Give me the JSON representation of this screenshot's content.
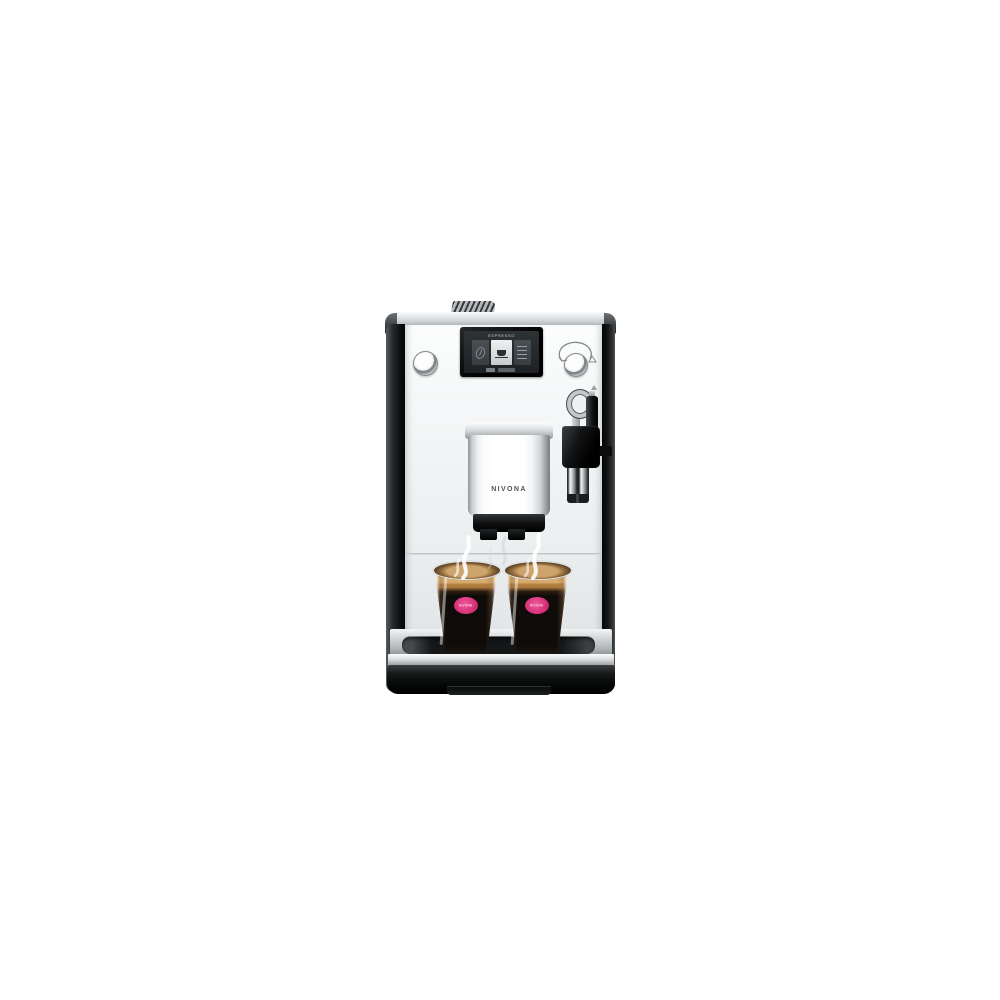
{
  "machine": {
    "brand": "NIVONA",
    "display": {
      "title": "ESPRESSO"
    },
    "spout_label": "NIVONA",
    "glasses": {
      "logo_text": "NIVONA"
    }
  },
  "colors": {
    "bg": "#ffffff",
    "panel-black": "#0b0c0d",
    "chrome-light": "#fafbfb",
    "chrome-dark": "#9ea3a6",
    "front-white": "#f4f6f7",
    "screen-bg": "#1d2124",
    "screen-text": "#c6cbcd",
    "crema": "#d8ab6b",
    "espresso": "#0e0b09",
    "logo-pink": "#d12d72"
  }
}
